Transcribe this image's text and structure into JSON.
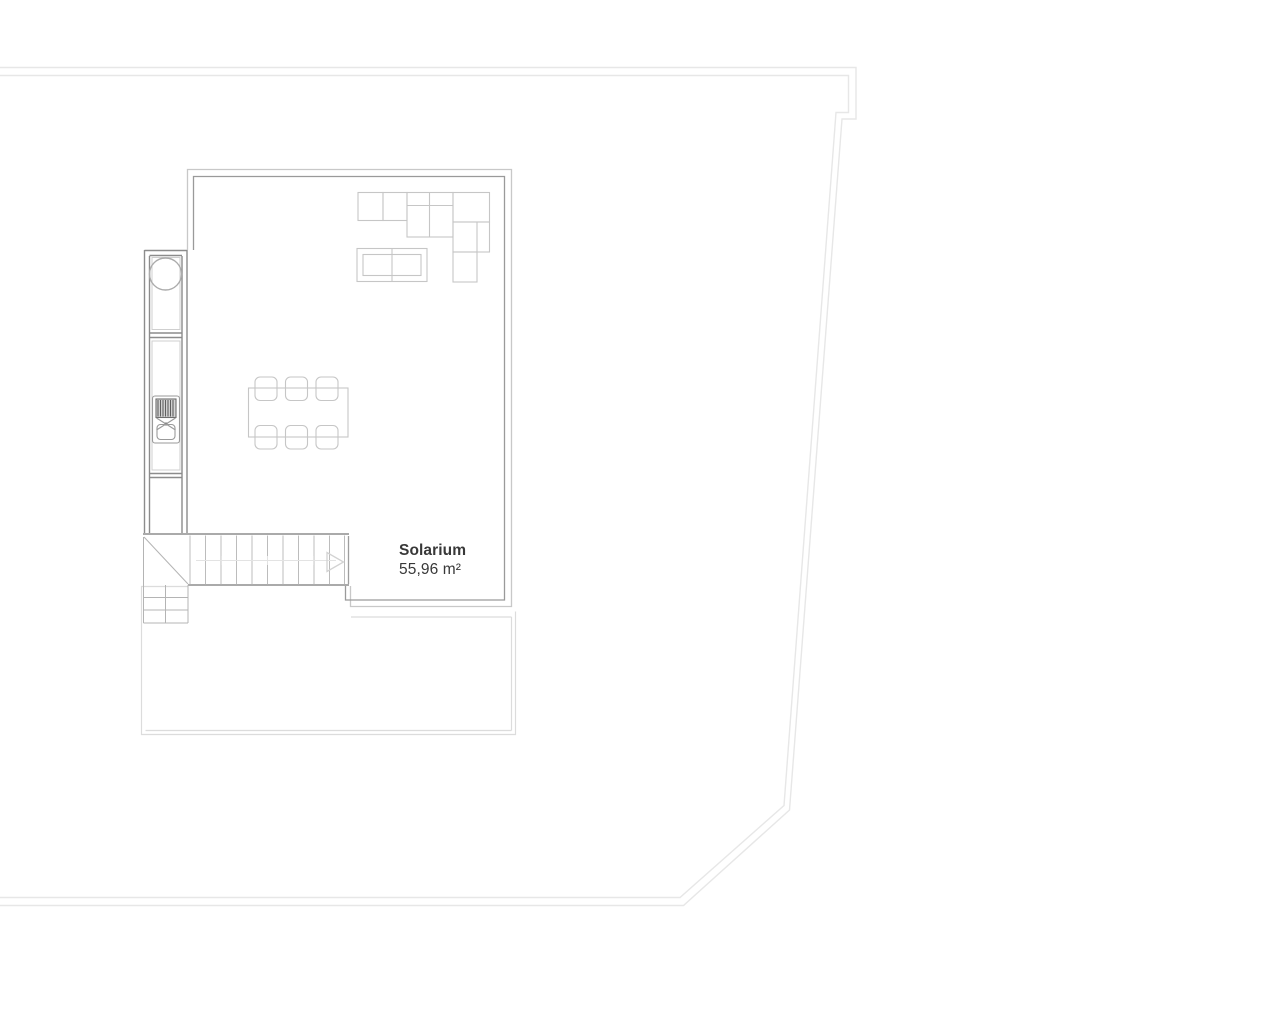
{
  "room_label": {
    "name": "Solarium",
    "area": "55,96 m²"
  },
  "plan": {
    "type": "architectural-floor-plan-solarium-level",
    "visible_counts": {
      "dining_chairs": 6,
      "sofa_modules": 6,
      "stair_treads": 10
    }
  },
  "colors": {
    "background": "#ffffff",
    "plot_boundary": "#e7e7e7",
    "wall_outer_light": "#c8c8c8",
    "wall_inner_dark": "#9a9a9a",
    "kitchen_strip_wall": "#8c8c8c",
    "strip_inner_line": "#cfcfcf",
    "round_table": "#ababab",
    "bbq_outline": "#9a9a9a",
    "grill_lines": "#5f5f5f",
    "furniture_outline": "#c6c6c6",
    "stair_edge_dark": "#9e9e9e",
    "stair_tread": "#bcbcbc",
    "winder_line": "#b4b4b4",
    "faint_guide": "#e3e3e3",
    "arrow_outline": "#d2d2d2",
    "terrace_outline": "#dcdcdc",
    "label_text": "#383838"
  }
}
